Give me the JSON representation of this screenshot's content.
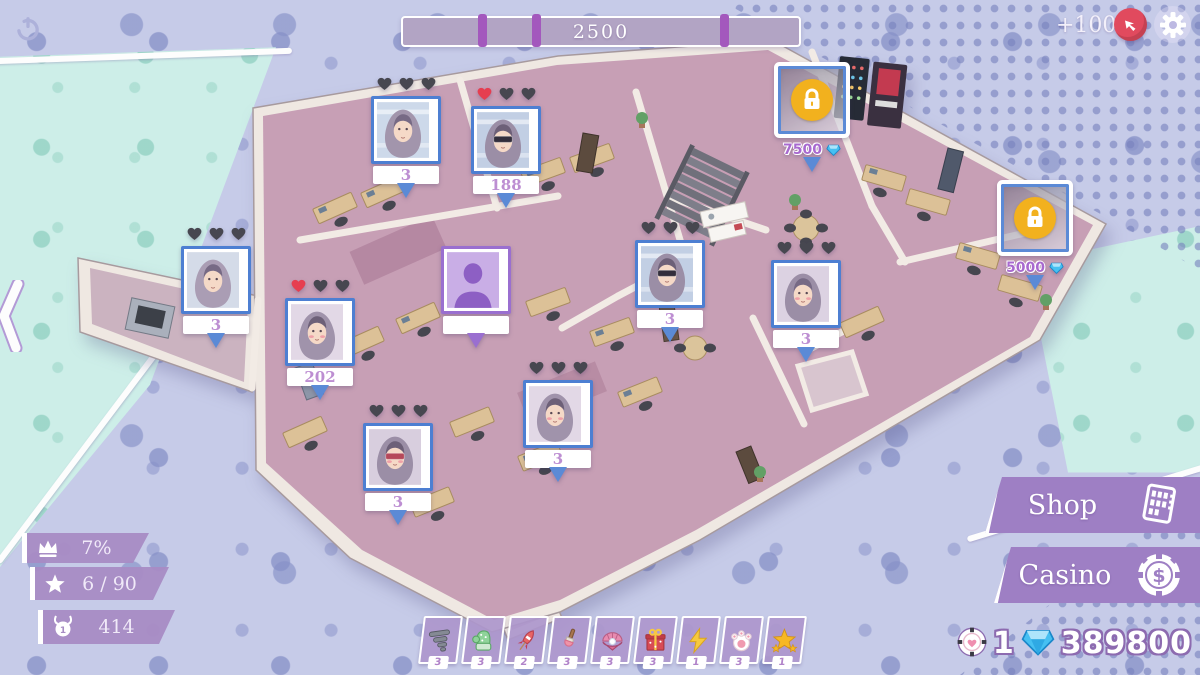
{
  "top_bar": {
    "progress": {
      "value": "2500",
      "notches_pct": [
        19,
        32.5,
        80
      ]
    },
    "reward_label": "+100"
  },
  "stats": {
    "items": [
      {
        "icon": "crown",
        "value": "7%"
      },
      {
        "icon": "star",
        "value": "6 / 90"
      },
      {
        "icon": "medal",
        "value": "414"
      }
    ]
  },
  "building": {
    "markers": [
      {
        "type": "character",
        "x": 366,
        "y": 76,
        "hearts": [
          "dark",
          "dark",
          "dark"
        ],
        "value": "3",
        "variant": "window"
      },
      {
        "type": "character",
        "x": 466,
        "y": 86,
        "hearts": [
          "red",
          "dark",
          "dark"
        ],
        "value": "188",
        "variant": "shades"
      },
      {
        "type": "character",
        "x": 176,
        "y": 226,
        "hearts": [
          "dark",
          "dark",
          "dark"
        ],
        "value": "3",
        "variant": "side"
      },
      {
        "type": "character",
        "x": 280,
        "y": 278,
        "hearts": [
          "red",
          "dark",
          "dark"
        ],
        "value": "202",
        "variant": "front"
      },
      {
        "type": "silhouette",
        "x": 436,
        "y": 246
      },
      {
        "type": "character",
        "x": 630,
        "y": 220,
        "hearts": [
          "dark",
          "dark",
          "dark"
        ],
        "value": "3",
        "variant": "shades"
      },
      {
        "type": "character",
        "x": 766,
        "y": 240,
        "hearts": [
          "dark",
          "dark",
          "dark"
        ],
        "value": "3",
        "variant": "blush"
      },
      {
        "type": "character",
        "x": 518,
        "y": 360,
        "hearts": [
          "dark",
          "dark",
          "dark"
        ],
        "value": "3",
        "variant": "front"
      },
      {
        "type": "character",
        "x": 358,
        "y": 403,
        "hearts": [
          "dark",
          "dark",
          "dark"
        ],
        "value": "3",
        "variant": "redvisor"
      },
      {
        "type": "locked",
        "x": 772,
        "y": 62,
        "price": "7500"
      },
      {
        "type": "locked",
        "x": 995,
        "y": 180,
        "price": "5000"
      }
    ]
  },
  "hotbar": {
    "items": [
      {
        "icon": "tornado",
        "count": "3"
      },
      {
        "icon": "mitten",
        "count": "3"
      },
      {
        "icon": "rocket",
        "count": "2"
      },
      {
        "icon": "brush",
        "count": "3"
      },
      {
        "icon": "clam",
        "count": "3"
      },
      {
        "icon": "gift",
        "count": "3"
      },
      {
        "icon": "lightning",
        "count": "1"
      },
      {
        "icon": "paw",
        "count": "3"
      },
      {
        "icon": "star",
        "count": "1"
      }
    ]
  },
  "menu": {
    "shop_label": "Shop",
    "casino_label": "Casino"
  },
  "wallet": {
    "chips": "1",
    "gems": "389800"
  },
  "colors": {
    "accent_purple": "#9e7fc4",
    "teal": "#cdeee8",
    "locked_gold": "#f2b11e",
    "heart_red": "#e63e50",
    "heart_dark": "#474750",
    "gem_blue": "#46c0f2",
    "marker_border_blue": "#4d7fd2",
    "floor_pink": "#c79fb5"
  }
}
